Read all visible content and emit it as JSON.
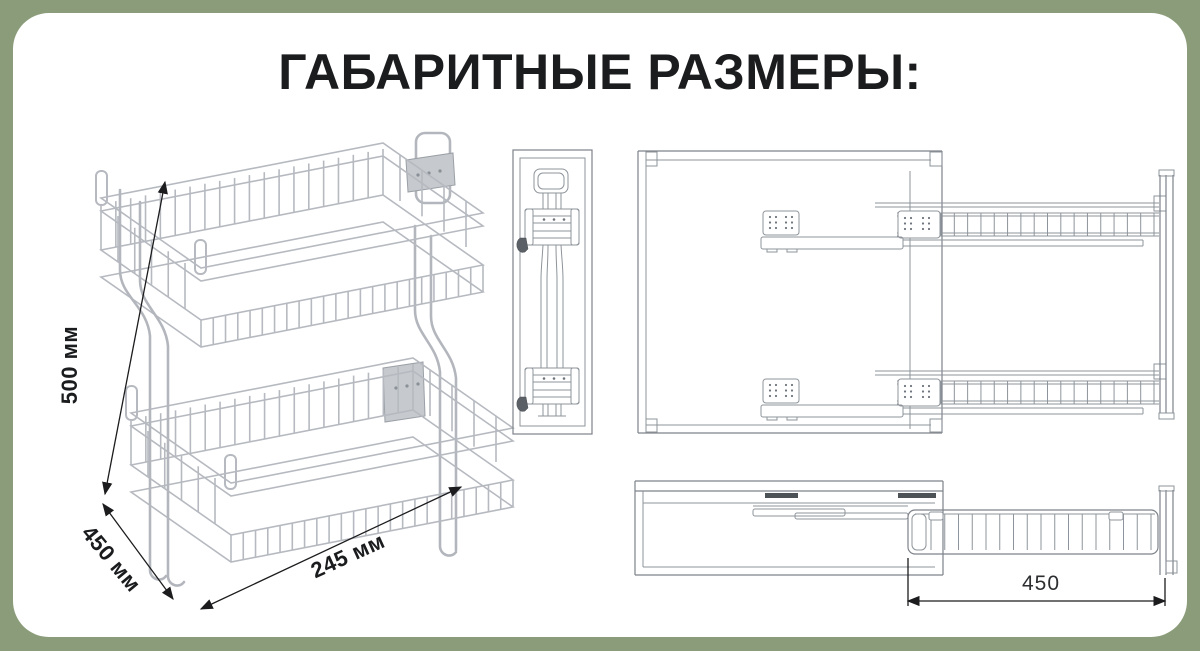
{
  "title": "ГАБАРИТНЫЕ РАЗМЕРЫ:",
  "dimensions": {
    "height": "500 мм",
    "depth": "450 мм",
    "width": "245 мм",
    "extension": "450"
  },
  "colors": {
    "background": "#8a9c79",
    "card": "#ffffff",
    "drawing_line": "#8e949b",
    "chrome_wire": "#b6bac0",
    "dimension": "#1c1c1e"
  }
}
